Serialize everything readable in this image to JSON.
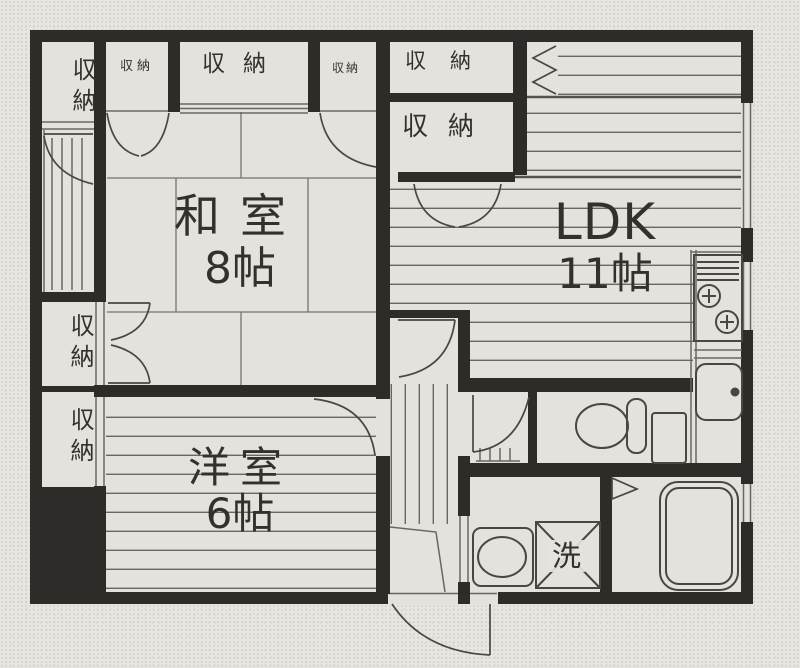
{
  "plan": {
    "colors": {
      "paper": "#e8e6e1",
      "floor": "#e4e2dc",
      "wall": "#2e2c29",
      "line": "#6a6763",
      "fixture": "#4a4743"
    },
    "rooms": {
      "washitsu": {
        "name": "和室",
        "size": "8帖"
      },
      "ldk": {
        "name": "LDK",
        "size": "11帖"
      },
      "youshitsu": {
        "name": "洋室",
        "size": "6帖"
      }
    },
    "labels": {
      "storage": "収納",
      "laundry": "洗"
    }
  }
}
